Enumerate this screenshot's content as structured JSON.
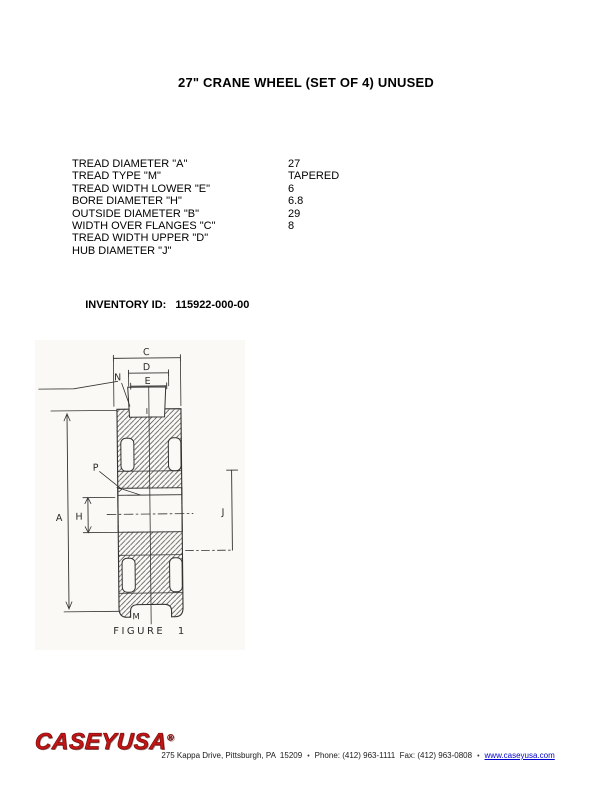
{
  "page": {
    "title": "27\" CRANE WHEEL (SET OF 4) UNUSED"
  },
  "specs": {
    "rows": [
      {
        "label": "TREAD DIAMETER \"A\"",
        "value": "27"
      },
      {
        "label": "TREAD TYPE \"M\"",
        "value": "TAPERED"
      },
      {
        "label": "TREAD WIDTH LOWER \"E\"",
        "value": "6"
      },
      {
        "label": "BORE DIAMETER \"H\"",
        "value": "6.8"
      },
      {
        "label": "OUTSIDE DIAMETER \"B\"",
        "value": "29"
      },
      {
        "label": "WIDTH OVER FLANGES \"C\"",
        "value": "8"
      },
      {
        "label": "TREAD WIDTH UPPER \"D\"",
        "value": ""
      },
      {
        "label": "HUB DIAMETER \"J\"",
        "value": ""
      }
    ]
  },
  "inventory": {
    "label": "INVENTORY ID:",
    "value": "115922-000-00"
  },
  "figure": {
    "caption": "FIGURE 1",
    "labels": {
      "A": "A",
      "C": "C",
      "D": "D",
      "E": "E",
      "H": "H",
      "I": "I",
      "J": "J",
      "M": "M",
      "N": "N",
      "P": "P"
    }
  },
  "footer": {
    "logo": "CASEYUSA",
    "registered_mark": "®",
    "address": "275 Kappa Drive, Pittsburgh, PA  15209",
    "bullet": "•",
    "phone": "Phone: (412) 963-1111  Fax: (412) 963-0808",
    "website": "www.caseyusa.com"
  },
  "colors": {
    "logo_red": "#c41515",
    "link_blue": "#0000cc",
    "ink": "#000000"
  }
}
